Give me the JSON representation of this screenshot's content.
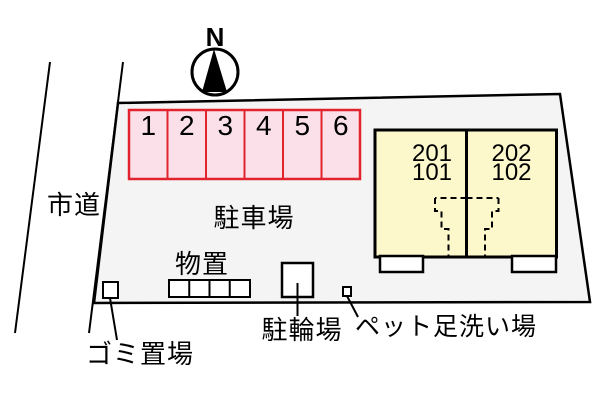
{
  "colors": {
    "property_fill": "#f4f4f4",
    "parking_fill": "#fbe0ea",
    "parking_stroke": "#e1232e",
    "building_fill": "#fcf8cc",
    "line_color": "#000000"
  },
  "compass": {
    "north_label": "N"
  },
  "road": {
    "label": "市道"
  },
  "parking": {
    "label": "駐車場",
    "stall_numbers": [
      "1",
      "2",
      "3",
      "4",
      "5",
      "6"
    ]
  },
  "building": {
    "units": [
      {
        "label": "201\n101"
      },
      {
        "label": "202\n102"
      }
    ]
  },
  "storage": {
    "label": "物置"
  },
  "garbage": {
    "label": "ゴミ置場"
  },
  "bicycle_parking": {
    "label": "駐輪場"
  },
  "pet_wash": {
    "label": "ペット足洗い場"
  }
}
